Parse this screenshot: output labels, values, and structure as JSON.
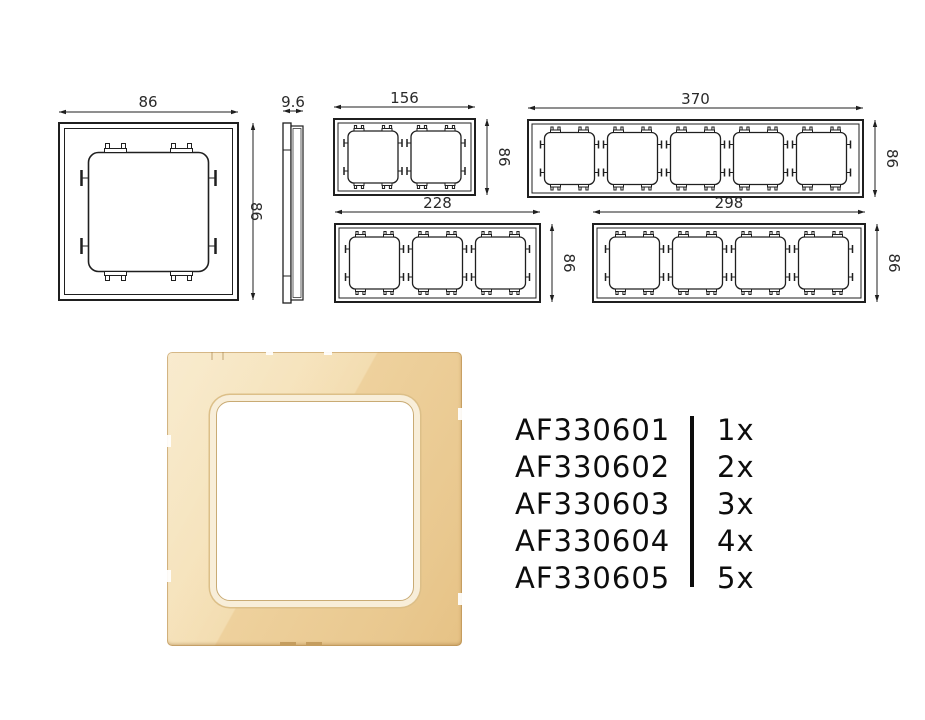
{
  "drawings": {
    "single_front": {
      "width_label": "86",
      "height_label": "86"
    },
    "side_profile": {
      "depth_label": "9.6"
    },
    "frame_2gang": {
      "width_label": "156",
      "height_label": "86"
    },
    "frame_3gang": {
      "width_label": "228",
      "height_label": "86"
    },
    "frame_4gang": {
      "width_label": "298",
      "height_label": "86"
    },
    "frame_5gang": {
      "width_label": "370",
      "height_label": "86"
    }
  },
  "product_list": {
    "items": [
      {
        "code": "AF330601",
        "quantity": "1x"
      },
      {
        "code": "AF330602",
        "quantity": "2x"
      },
      {
        "code": "AF330603",
        "quantity": "3x"
      },
      {
        "code": "AF330604",
        "quantity": "4x"
      },
      {
        "code": "AF330605",
        "quantity": "5x"
      }
    ]
  },
  "colors": {
    "drawing_line": "#1f1f1f",
    "dimension_text": "#2a2a2a",
    "list_text": "#0d0d0d",
    "frame_gold_light": "#f6e3ba",
    "frame_gold_dark": "#e6c285",
    "opening_ring_cream": "#f8eed9",
    "opening_ring_gold": "#dcbf88"
  }
}
